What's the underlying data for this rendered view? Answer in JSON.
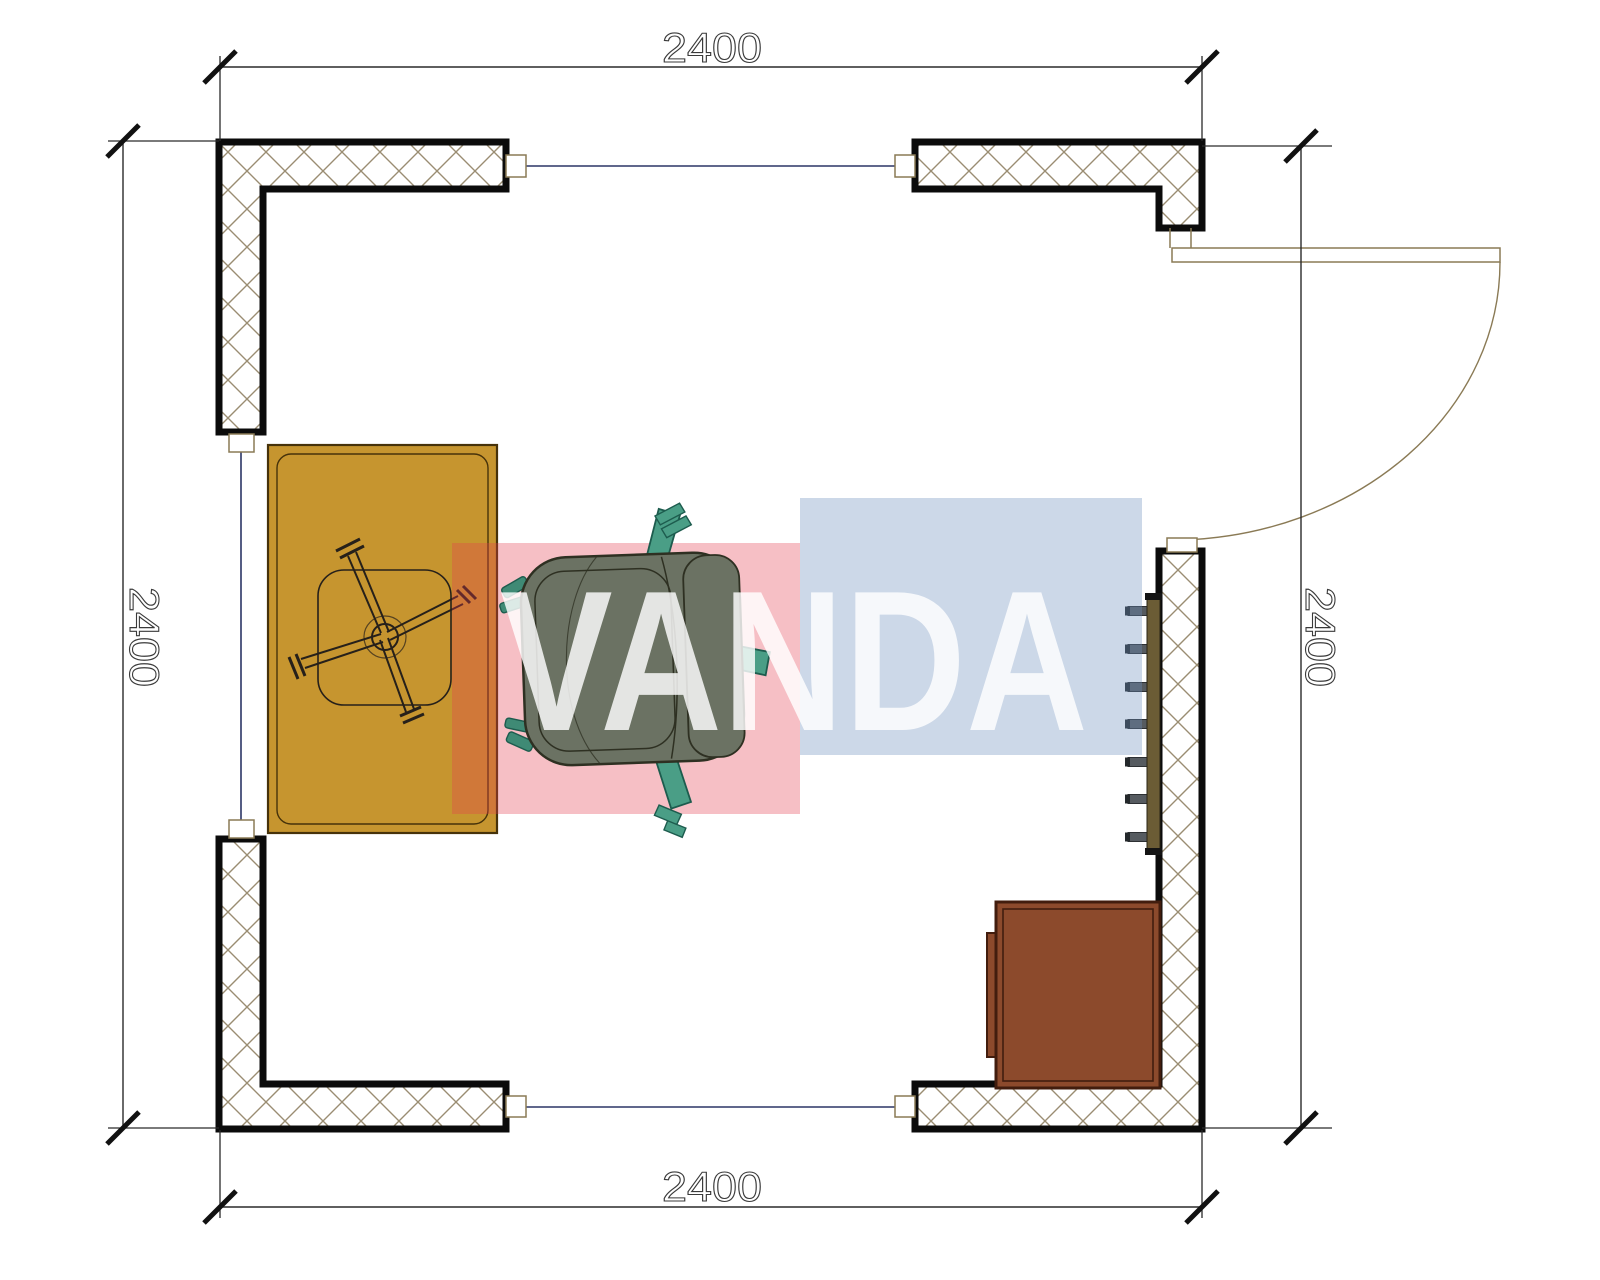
{
  "document": {
    "type": "floor-plan",
    "description": "Top-view CAD floor plan of a 2400x2400 room with cross-hatched walls, three windows, a right-side swing door, desk with swivel-chair base, executive office chair, cabinet and wall coat rack",
    "background": "#ffffff"
  },
  "dimensions": {
    "top": "2400",
    "bottom": "2400",
    "left": "2400",
    "right": "2400"
  },
  "watermark": {
    "text": "VANDA",
    "text_color": "#ffffff",
    "red_block_color": "#e53e4f",
    "blue_block_color": "#6c90be"
  },
  "colors": {
    "wall_outline": "#0b0b0b",
    "wall_hatch": "#9a8d72",
    "dimension_line": "#2a2a2a",
    "tick": "#111111",
    "window_line": "#2b3566",
    "door_line": "#8a7a55",
    "desk": "#c6952f",
    "desk_outline": "#46320a",
    "chair_seat": "#6b7263",
    "chair_outline": "#2e3022",
    "chair_accent": "#4a9e86",
    "chair_accent_outline": "#1d5c4e",
    "cabinet": "#8c4a2c",
    "cabinet_outline": "#421d0e",
    "coat_rack": "#6b5c35",
    "hook": "#565b60"
  },
  "objects": {
    "walls": [
      "top-left L wall",
      "top-right L wall",
      "right-and-bottom-right L wall",
      "bottom-left L wall"
    ],
    "windows": [
      "top window",
      "left window",
      "bottom window"
    ],
    "door": "right side door shown open with quarter-circle swing arc",
    "furniture": [
      "desk",
      "swivel-chair-base",
      "office-chair",
      "cabinet",
      "coat-rack with 7 hooks"
    ]
  }
}
